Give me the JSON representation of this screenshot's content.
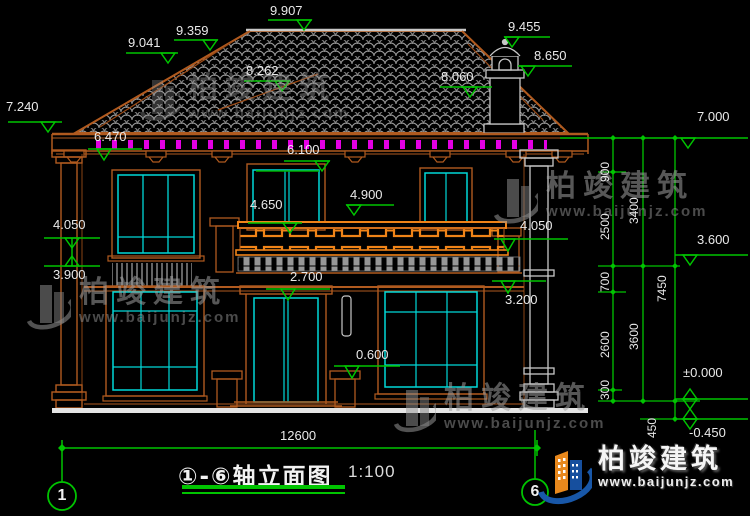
{
  "drawing": {
    "title": "①-⑥轴立面图",
    "scale": "1:100",
    "axis_start": "1",
    "axis_end": "6",
    "total_width_dim": "12600"
  },
  "levels": {
    "v7240": "7.240",
    "v9041": "9.041",
    "v9359": "9.359",
    "v9907": "9.907",
    "v8262": "8.262",
    "v9455": "9.455",
    "v8650": "8.650",
    "v8060": "8.060",
    "v7000": "7.000",
    "v6470": "6.470",
    "v6100": "6.100",
    "v4900": "4.900",
    "v4650": "4.650",
    "v4050l": "4.050",
    "v3900": "3.900",
    "v4050r": "4.050",
    "v3600": "3.600",
    "v3200": "3.200",
    "v2700": "2.700",
    "v0600": "0.600",
    "vzero": "±0.000",
    "vneg450": "-0.450"
  },
  "vdims": {
    "d900": "900",
    "d2500": "2500",
    "d3400": "3400",
    "d700": "700",
    "d2600": "2600",
    "d3600": "3600",
    "d300": "300",
    "d450": "450",
    "d7450": "7450"
  },
  "watermark": {
    "brand": "柏竣建筑",
    "url": "www.baijunjz.com"
  },
  "logo": {
    "brand": "柏竣建筑",
    "url": "www.baijunjz.com"
  }
}
